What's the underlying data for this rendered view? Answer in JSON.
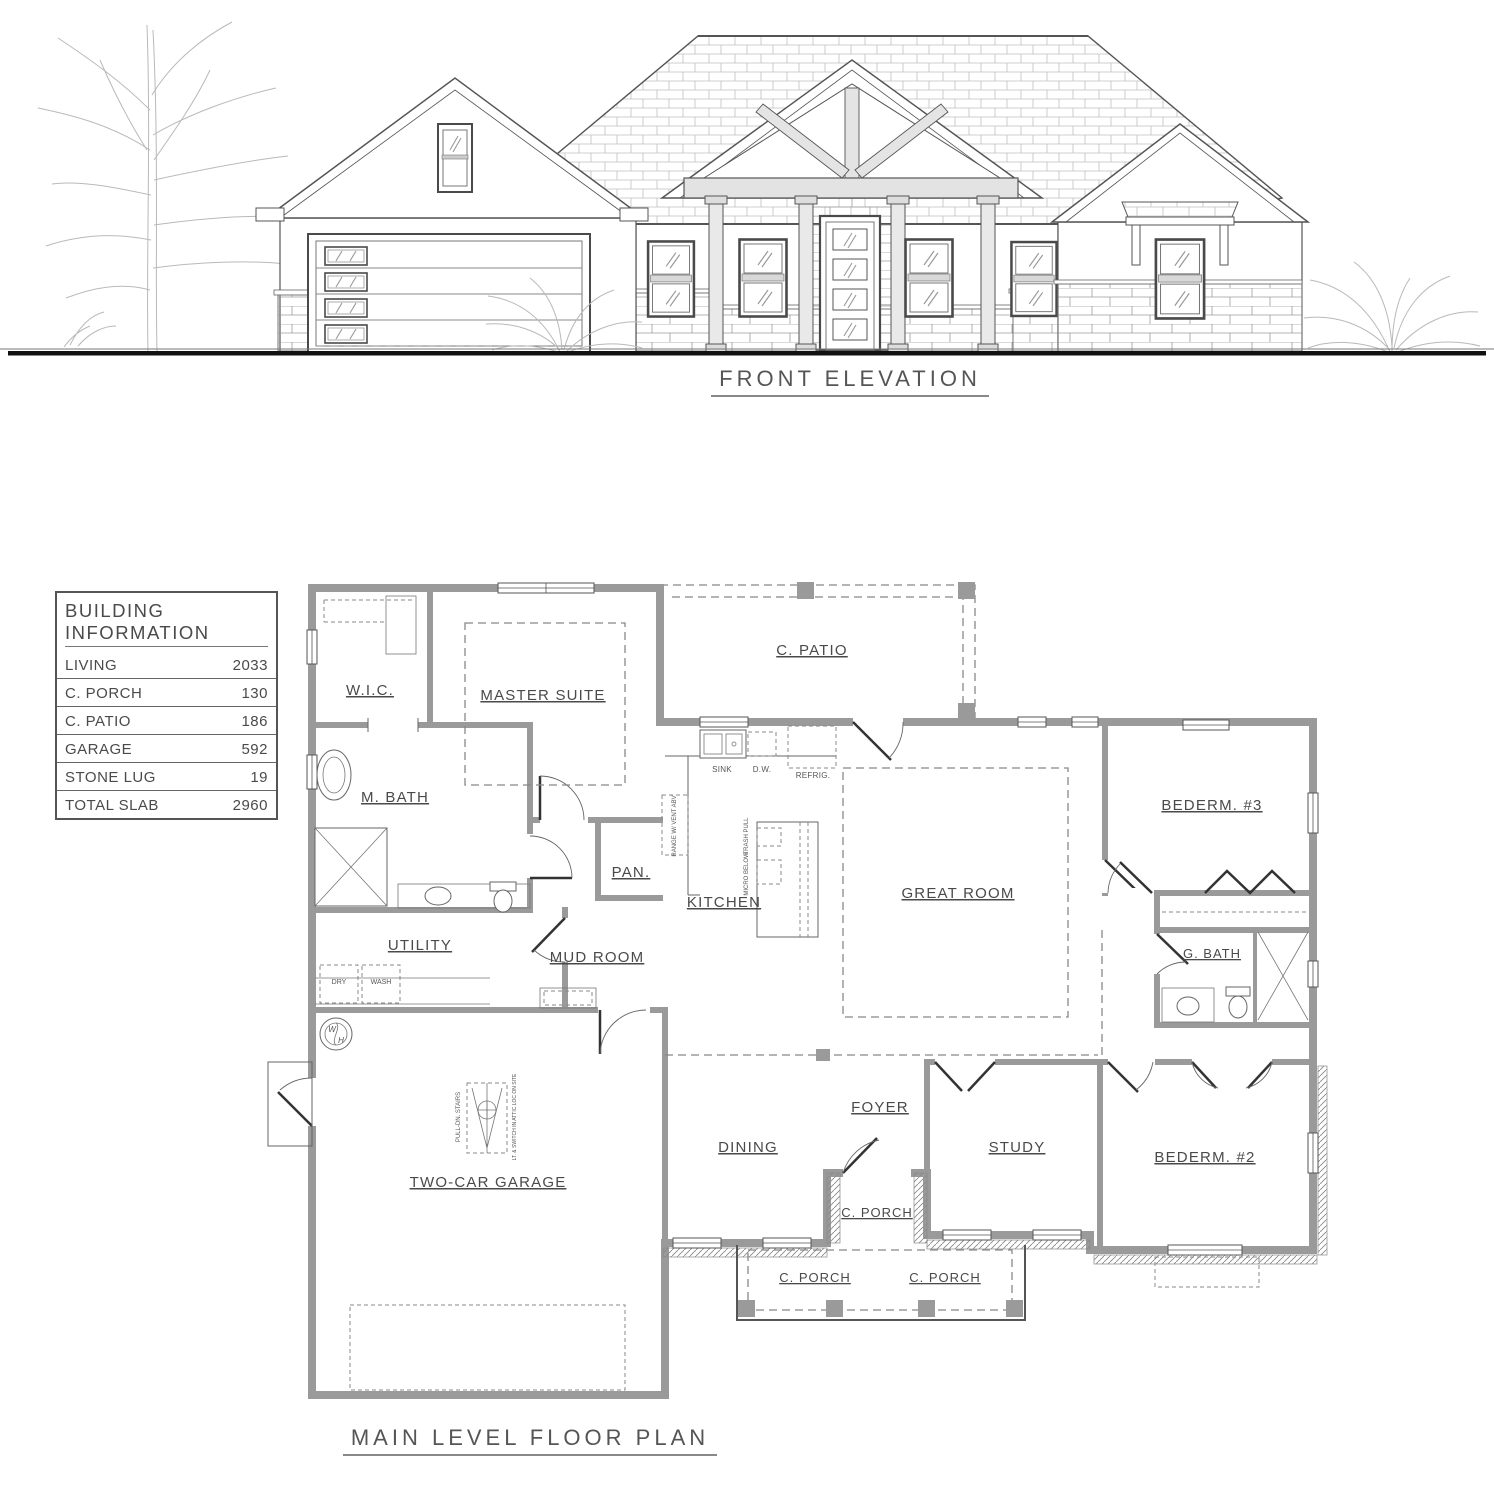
{
  "elevation": {
    "title": "FRONT ELEVATION"
  },
  "building_info": {
    "title": "BUILDING INFORMATION",
    "rows": [
      {
        "label": "LIVING",
        "value": "2033"
      },
      {
        "label": "C. PORCH",
        "value": "130"
      },
      {
        "label": "C. PATIO",
        "value": "186"
      },
      {
        "label": "GARAGE",
        "value": "592"
      },
      {
        "label": "STONE LUG",
        "value": "19"
      },
      {
        "label": "TOTAL SLAB",
        "value": "2960"
      }
    ]
  },
  "floor_plan": {
    "title": "MAIN LEVEL FLOOR PLAN",
    "rooms": {
      "c_patio": "C. PATIO",
      "wic": "W.I.C.",
      "master_suite": "MASTER SUITE",
      "m_bath": "M. BATH",
      "pantry": "PAN.",
      "kitchen": "KITCHEN",
      "great_room": "GREAT ROOM",
      "bedroom3": "BEDERM. #3",
      "g_bath": "G. BATH",
      "utility": "UTILITY",
      "mud_room": "MUD ROOM",
      "garage": "TWO-CAR GARAGE",
      "dining": "DINING",
      "foyer": "FOYER",
      "study": "STUDY",
      "bedroom2": "BEDERM. #2",
      "porch_entry": "C. PORCH",
      "porch_left": "C. PORCH",
      "porch_right": "C. PORCH"
    },
    "annotations": {
      "sink": "SINK",
      "dishwasher": "D.W.",
      "refrigerator": "REFRIG.",
      "trash_pull": "TRASH PULL",
      "micro_below": "MICRO BELOW",
      "range": "RANGE W/ VENT ABV",
      "dry": "DRY",
      "wash": "WASH",
      "pull_down_stairs": "PULL-DN. STAIRS",
      "attic_note": "LT. & SWITCH IN ATTIC LOC ON SITE",
      "water_heater_w": "W",
      "water_heater_h": "H"
    }
  },
  "colors": {
    "wall_gray": "#9a9a9a",
    "line_dark": "#4a4a4a",
    "timber_fill": "#e4e4e4",
    "ground_black": "#111111"
  }
}
